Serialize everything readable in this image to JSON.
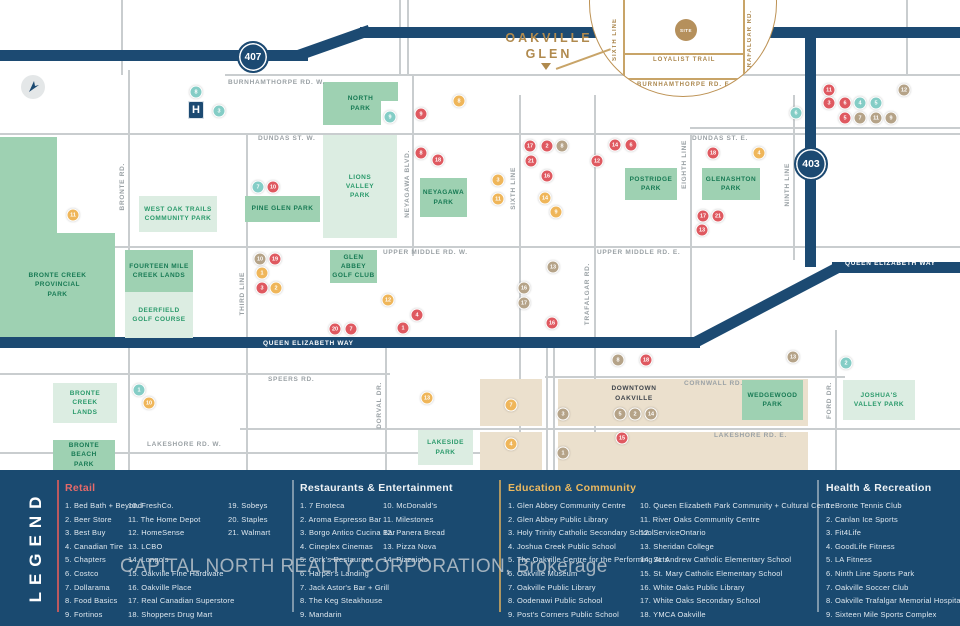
{
  "callout": {
    "title": "OAKVILLE\nGLEN",
    "site_label": "SITE",
    "loyalist": "LOYALIST TRAIL",
    "sixth": "SIXTH LINE",
    "trafalgar": "TRAFALGAR RD.",
    "burnhamthorpe": "BURNHAMTHORPE RD. E."
  },
  "highways": {
    "h407": "407",
    "h403": "403",
    "qew": "QUEEN ELIZABETH WAY"
  },
  "map": {
    "hospital": "H",
    "downtown": "DOWNTOWN\nOAKVILLE",
    "road_labels": [
      {
        "x": 228,
        "y": 79,
        "t": "BURNHAMTHORPE RD. W."
      },
      {
        "x": 258,
        "y": 135,
        "t": "DUNDAS ST. W."
      },
      {
        "x": 692,
        "y": 135,
        "t": "DUNDAS ST. E."
      },
      {
        "x": 383,
        "y": 249,
        "t": "UPPER MIDDLE RD. W."
      },
      {
        "x": 597,
        "y": 249,
        "t": "UPPER MIDDLE RD. E."
      },
      {
        "x": 268,
        "y": 376,
        "t": "SPEERS RD."
      },
      {
        "x": 684,
        "y": 380,
        "t": "CORNWALL RD."
      },
      {
        "x": 147,
        "y": 441,
        "t": "LAKESHORE RD. W."
      },
      {
        "x": 714,
        "y": 432,
        "t": "LAKESHORE RD. E."
      },
      {
        "x": 119,
        "y": 163,
        "t": "BRONTE RD.",
        "v": 1
      },
      {
        "x": 239,
        "y": 272,
        "t": "THIRD LINE",
        "v": 1
      },
      {
        "x": 404,
        "y": 150,
        "t": "NEYAGAWA BLVD.",
        "v": 1
      },
      {
        "x": 510,
        "y": 167,
        "t": "SIXTH LINE",
        "v": 1
      },
      {
        "x": 584,
        "y": 263,
        "t": "TRAFALGAR RD.",
        "v": 1
      },
      {
        "x": 681,
        "y": 140,
        "t": "EIGHTH LINE",
        "v": 1
      },
      {
        "x": 784,
        "y": 163,
        "t": "NINTH LINE",
        "v": 1
      },
      {
        "x": 826,
        "y": 382,
        "t": "FORD DR.",
        "v": 1
      },
      {
        "x": 376,
        "y": 382,
        "t": "DORVAL DR.",
        "v": 1
      },
      {
        "x": 263,
        "y": 340,
        "t": "QUEEN ELIZABETH WAY",
        "w": 1
      },
      {
        "x": 845,
        "y": 260,
        "t": "QUEEN ELIZABETH WAY",
        "w": 1
      }
    ],
    "roads": {
      "vertical": [
        {
          "x": 121,
          "y": 0,
          "h": 75
        },
        {
          "x": 399,
          "y": 0,
          "h": 75
        },
        {
          "x": 407,
          "y": 0,
          "h": 75
        },
        {
          "x": 906,
          "y": 0,
          "h": 75
        },
        {
          "x": 128,
          "y": 70,
          "h": 400
        },
        {
          "x": 246,
          "y": 133,
          "h": 337
        },
        {
          "x": 412,
          "y": 74,
          "h": 182
        },
        {
          "x": 519,
          "y": 95,
          "h": 375
        },
        {
          "x": 594,
          "y": 95,
          "h": 375
        },
        {
          "x": 690,
          "y": 133,
          "h": 204
        },
        {
          "x": 793,
          "y": 95,
          "h": 165
        },
        {
          "x": 385,
          "y": 340,
          "h": 130
        },
        {
          "x": 546,
          "y": 340,
          "h": 130
        },
        {
          "x": 553,
          "y": 340,
          "h": 130
        },
        {
          "x": 835,
          "y": 330,
          "h": 140
        }
      ],
      "horizontal": [
        {
          "x": 225,
          "y": 74,
          "w": 735
        },
        {
          "x": 0,
          "y": 133,
          "w": 960
        },
        {
          "x": 690,
          "y": 127,
          "w": 270
        },
        {
          "x": 0,
          "y": 246,
          "w": 960
        },
        {
          "x": 0,
          "y": 373,
          "w": 390
        },
        {
          "x": 545,
          "y": 376,
          "w": 300
        },
        {
          "x": 240,
          "y": 428,
          "w": 720
        },
        {
          "x": 0,
          "y": 452,
          "w": 480
        }
      ]
    },
    "downtown_blocks": [
      {
        "x": 480,
        "y": 379,
        "w": 62,
        "h": 47
      },
      {
        "x": 480,
        "y": 432,
        "w": 62,
        "h": 38
      },
      {
        "x": 558,
        "y": 379,
        "w": 250,
        "h": 47
      },
      {
        "x": 558,
        "y": 432,
        "w": 250,
        "h": 38
      }
    ],
    "parks": [
      {
        "x": 0,
        "y": 137,
        "w": 57,
        "h": 96,
        "s": "m",
        "name": ""
      },
      {
        "x": 0,
        "y": 233,
        "w": 115,
        "h": 104,
        "s": "m",
        "name": "BRONTE CREEK\nPROVINCIAL\nPARK"
      },
      {
        "x": 139,
        "y": 196,
        "w": 78,
        "h": 36,
        "s": "l",
        "name": "WEST OAK TRAILS\nCOMMUNITY PARK"
      },
      {
        "x": 245,
        "y": 196,
        "w": 75,
        "h": 26,
        "s": "m",
        "name": "PINE GLEN PARK"
      },
      {
        "x": 323,
        "y": 82,
        "w": 75,
        "h": 43,
        "s": "m",
        "name": "NORTH\nPARK"
      },
      {
        "x": 323,
        "y": 135,
        "w": 74,
        "h": 103,
        "s": "l",
        "name": "LIONS\nVALLEY\nPARK"
      },
      {
        "x": 420,
        "y": 178,
        "w": 47,
        "h": 39,
        "s": "m",
        "name": "NEYAGAWA\nPARK"
      },
      {
        "x": 125,
        "y": 250,
        "w": 68,
        "h": 42,
        "s": "m",
        "name": "FOURTEEN MILE\nCREEK LANDS"
      },
      {
        "x": 125,
        "y": 292,
        "w": 68,
        "h": 46,
        "s": "l",
        "name": "DEERFIELD\nGOLF COURSE"
      },
      {
        "x": 330,
        "y": 250,
        "w": 47,
        "h": 33,
        "s": "m",
        "name": "GLEN ABBEY\nGOLF CLUB"
      },
      {
        "x": 625,
        "y": 168,
        "w": 52,
        "h": 32,
        "s": "m",
        "name": "POSTRIDGE\nPARK"
      },
      {
        "x": 702,
        "y": 168,
        "w": 58,
        "h": 32,
        "s": "m",
        "name": "GLENASHTON\nPARK"
      },
      {
        "x": 53,
        "y": 383,
        "w": 64,
        "h": 40,
        "s": "l",
        "name": "BRONTE\nCREEK\nLANDS"
      },
      {
        "x": 53,
        "y": 440,
        "w": 62,
        "h": 30,
        "s": "m",
        "name": "BRONTE\nBEACH\nPARK"
      },
      {
        "x": 418,
        "y": 430,
        "w": 55,
        "h": 35,
        "s": "l",
        "name": "LAKESIDE\nPARK"
      },
      {
        "x": 742,
        "y": 380,
        "w": 61,
        "h": 40,
        "s": "m",
        "name": "WEDGEWOOD\nPARK"
      },
      {
        "x": 843,
        "y": 380,
        "w": 72,
        "h": 40,
        "s": "l",
        "name": "JOSHUA'S\nVALLEY PARK"
      }
    ],
    "markers": [
      {
        "x": 196,
        "y": 92,
        "c": "c",
        "n": "8"
      },
      {
        "x": 219,
        "y": 111,
        "c": "c",
        "n": "3"
      },
      {
        "x": 390,
        "y": 117,
        "c": "c",
        "n": "9"
      },
      {
        "x": 258,
        "y": 187,
        "c": "c",
        "n": "7"
      },
      {
        "x": 139,
        "y": 390,
        "c": "c",
        "n": "1"
      },
      {
        "x": 846,
        "y": 363,
        "c": "c",
        "n": "2"
      },
      {
        "x": 860,
        "y": 103,
        "c": "c",
        "n": "4"
      },
      {
        "x": 876,
        "y": 103,
        "c": "c",
        "n": "5"
      },
      {
        "x": 796,
        "y": 113,
        "c": "c",
        "n": "6"
      },
      {
        "x": 829,
        "y": 90,
        "c": "r",
        "n": "11"
      },
      {
        "x": 829,
        "y": 103,
        "c": "r",
        "n": "3"
      },
      {
        "x": 845,
        "y": 103,
        "c": "r",
        "n": "6"
      },
      {
        "x": 845,
        "y": 118,
        "c": "r",
        "n": "5"
      },
      {
        "x": 421,
        "y": 114,
        "c": "r",
        "n": "9"
      },
      {
        "x": 421,
        "y": 153,
        "c": "r",
        "n": "8"
      },
      {
        "x": 438,
        "y": 160,
        "c": "r",
        "n": "18"
      },
      {
        "x": 530,
        "y": 146,
        "c": "r",
        "n": "17"
      },
      {
        "x": 547,
        "y": 146,
        "c": "r",
        "n": "2"
      },
      {
        "x": 562,
        "y": 146,
        "c": "t",
        "n": "8"
      },
      {
        "x": 531,
        "y": 161,
        "c": "r",
        "n": "21"
      },
      {
        "x": 547,
        "y": 176,
        "c": "r",
        "n": "16"
      },
      {
        "x": 615,
        "y": 145,
        "c": "r",
        "n": "14"
      },
      {
        "x": 631,
        "y": 145,
        "c": "r",
        "n": "6"
      },
      {
        "x": 597,
        "y": 161,
        "c": "r",
        "n": "12"
      },
      {
        "x": 713,
        "y": 153,
        "c": "r",
        "n": "18"
      },
      {
        "x": 759,
        "y": 153,
        "c": "o",
        "n": "4"
      },
      {
        "x": 703,
        "y": 216,
        "c": "r",
        "n": "17"
      },
      {
        "x": 718,
        "y": 216,
        "c": "r",
        "n": "21"
      },
      {
        "x": 702,
        "y": 230,
        "c": "r",
        "n": "13"
      },
      {
        "x": 260,
        "y": 259,
        "c": "t",
        "n": "10"
      },
      {
        "x": 275,
        "y": 259,
        "c": "r",
        "n": "19"
      },
      {
        "x": 262,
        "y": 273,
        "c": "o",
        "n": "1"
      },
      {
        "x": 262,
        "y": 288,
        "c": "r",
        "n": "3"
      },
      {
        "x": 276,
        "y": 288,
        "c": "o",
        "n": "2"
      },
      {
        "x": 273,
        "y": 187,
        "c": "r",
        "n": "10"
      },
      {
        "x": 459,
        "y": 101,
        "c": "o",
        "n": "8"
      },
      {
        "x": 498,
        "y": 180,
        "c": "o",
        "n": "3"
      },
      {
        "x": 498,
        "y": 199,
        "c": "o",
        "n": "11"
      },
      {
        "x": 545,
        "y": 198,
        "c": "o",
        "n": "14"
      },
      {
        "x": 556,
        "y": 212,
        "c": "o",
        "n": "9"
      },
      {
        "x": 73,
        "y": 215,
        "c": "o",
        "n": "11"
      },
      {
        "x": 388,
        "y": 300,
        "c": "o",
        "n": "12"
      },
      {
        "x": 417,
        "y": 315,
        "c": "r",
        "n": "4"
      },
      {
        "x": 403,
        "y": 328,
        "c": "r",
        "n": "1"
      },
      {
        "x": 335,
        "y": 329,
        "c": "r",
        "n": "20"
      },
      {
        "x": 351,
        "y": 329,
        "c": "r",
        "n": "7"
      },
      {
        "x": 553,
        "y": 267,
        "c": "t",
        "n": "13"
      },
      {
        "x": 524,
        "y": 288,
        "c": "t",
        "n": "16"
      },
      {
        "x": 524,
        "y": 303,
        "c": "t",
        "n": "17"
      },
      {
        "x": 552,
        "y": 323,
        "c": "r",
        "n": "16"
      },
      {
        "x": 904,
        "y": 90,
        "c": "t",
        "n": "12"
      },
      {
        "x": 860,
        "y": 118,
        "c": "t",
        "n": "7"
      },
      {
        "x": 876,
        "y": 118,
        "c": "t",
        "n": "11"
      },
      {
        "x": 891,
        "y": 118,
        "c": "t",
        "n": "9"
      },
      {
        "x": 149,
        "y": 403,
        "c": "o",
        "n": "10"
      },
      {
        "x": 427,
        "y": 398,
        "c": "o",
        "n": "13"
      },
      {
        "x": 511,
        "y": 405,
        "c": "o",
        "n": "7"
      },
      {
        "x": 511,
        "y": 444,
        "c": "o",
        "n": "4"
      },
      {
        "x": 563,
        "y": 414,
        "c": "t",
        "n": "3"
      },
      {
        "x": 563,
        "y": 453,
        "c": "t",
        "n": "1"
      },
      {
        "x": 618,
        "y": 360,
        "c": "t",
        "n": "8"
      },
      {
        "x": 646,
        "y": 360,
        "c": "r",
        "n": "18"
      },
      {
        "x": 620,
        "y": 414,
        "c": "t",
        "n": "5"
      },
      {
        "x": 635,
        "y": 414,
        "c": "t",
        "n": "2"
      },
      {
        "x": 651,
        "y": 414,
        "c": "t",
        "n": "14"
      },
      {
        "x": 622,
        "y": 438,
        "c": "r",
        "n": "15"
      },
      {
        "x": 793,
        "y": 357,
        "c": "t",
        "n": "13"
      }
    ]
  },
  "legend": {
    "panel_title": "LEGEND",
    "sections": [
      {
        "key": "retail",
        "title": "Retail",
        "color": "#e66a6a",
        "x": 65,
        "cols": [
          {
            "dx": 0,
            "items": [
              "Bed Bath + Beyond",
              "Beer Store",
              "Best Buy",
              "Canadian Tire",
              "Chapters",
              "Costco",
              "Dollarama",
              "Food Basics",
              "Fortinos"
            ]
          },
          {
            "dx": 63,
            "items": [
              "FreshCo.",
              "The Home Depot",
              "HomeSense",
              "LCBO",
              "Longo's",
              "Oakville Fine Hardware",
              "Oakville Place",
              "Real Canadian Superstore",
              "Shoppers Drug Mart"
            ]
          },
          {
            "dx": 163,
            "items": [
              "Sobeys",
              "Staples",
              "Walmart"
            ]
          }
        ]
      },
      {
        "key": "restaurants",
        "title": "Restaurants & Entertainment",
        "color": "#eef2f5",
        "x": 300,
        "cols": [
          {
            "dx": 0,
            "items": [
              "7 Enoteca",
              "Aroma Espresso Bar",
              "Borgo Antico Cucina Bar",
              "Cineplex Cinemas",
              "Cork's Restaurant",
              "Harper's Landing",
              "Jack Astor's Bar + Grill",
              "The Keg Steakhouse",
              "Mandarin"
            ]
          },
          {
            "dx": 83,
            "items": [
              "McDonald's",
              "Milestones",
              "Panera Bread",
              "Pizza Nova",
              "Pizzaiolo"
            ]
          }
        ]
      },
      {
        "key": "education",
        "title": "Education & Community",
        "color": "#ecb95f",
        "x": 508,
        "cols": [
          {
            "dx": 0,
            "items": [
              "Glen Abbey Community Centre",
              "Glen Abbey Public Library",
              "Holy Trinity Catholic Secondary School",
              "Joshua Creek Public School",
              "The Oakville Centre for the Performing Arts",
              "Oakville Museum",
              "Oakville Public Library",
              "Oodenawi Public School",
              "Post's Corners Public School"
            ]
          },
          {
            "dx": 132,
            "items": [
              "Queen Elizabeth Park Community + Cultural Centre",
              "River Oaks Community Centre",
              "ServiceOntario",
              "Sheridan College",
              "St. Andrew Catholic Elementary School",
              "St. Mary Catholic Elementary School",
              "White Oaks Public Library",
              "White Oaks Secondary School",
              "YMCA Oakville"
            ]
          }
        ]
      },
      {
        "key": "health",
        "title": "Health & Recreation",
        "color": "#eef2f5",
        "x": 826,
        "cols": [
          {
            "dx": 0,
            "items": [
              "Bronte Tennis Club",
              "Canlan Ice Sports",
              "Fit4Life",
              "GoodLife Fitness",
              "LA Fitness",
              "Ninth Line Sports Park",
              "Oakville Soccer Club",
              "Oakville Trafalgar Memorial Hospital",
              "Sixteen Mile Sports Complex"
            ]
          }
        ]
      }
    ],
    "dividers": [
      {
        "x": 57,
        "color": "#d95c5c"
      },
      {
        "x": 292,
        "color": "#8fa5b5"
      },
      {
        "x": 499,
        "color": "#caa55f"
      },
      {
        "x": 817,
        "color": "#8fa5b5"
      }
    ]
  },
  "watermark": "CAPITAL NORTH REALTY CORPORATION, Brokerage",
  "colors": {
    "navy": "#1c4a72",
    "road_gray": "#c9cdcf",
    "park_medium": "#9ed1b2",
    "park_light": "#dcede2",
    "beige": "#ebe0cd",
    "gold": "#b08a4e",
    "marker_retail": "#df5960",
    "marker_restaurant": "#efb65a",
    "marker_education": "#b5a388",
    "marker_health": "#84cdc6"
  }
}
